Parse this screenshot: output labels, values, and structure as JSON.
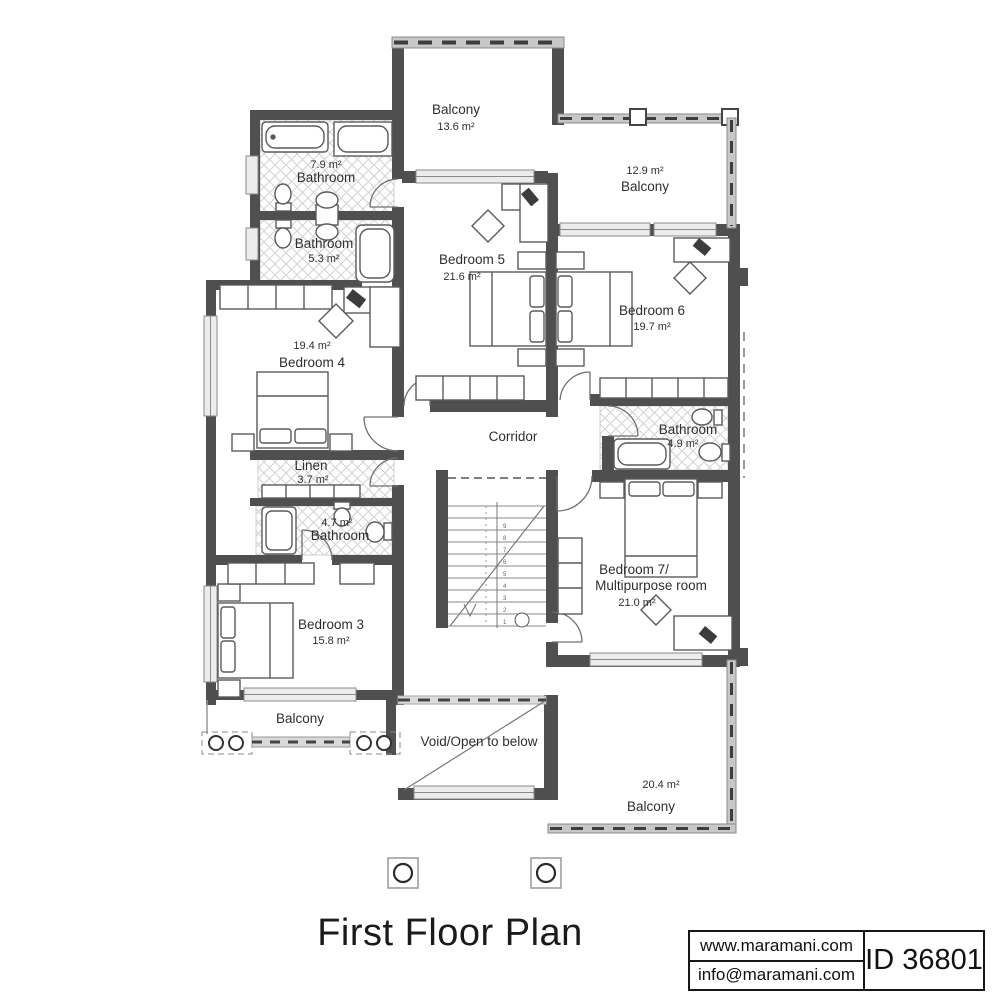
{
  "title": "First Floor Plan",
  "branding": {
    "website": "www.maramani.com",
    "email": "info@maramani.com",
    "plan_id": "ID 36801"
  },
  "rooms": {
    "balcony_top": {
      "name": "Balcony",
      "area": "13.6 m²"
    },
    "balcony_right": {
      "area": "12.9 m²",
      "name": "Balcony"
    },
    "bathroom_top": {
      "area": "7.9 m²",
      "name": "Bathroom"
    },
    "bathroom_mid": {
      "name": "Bathroom",
      "area": "5.3 m²"
    },
    "bedroom5": {
      "name": "Bedroom 5",
      "area": "21.6 m²"
    },
    "bedroom6": {
      "name": "Bedroom 6",
      "area": "19.7 m²"
    },
    "bedroom4": {
      "area": "19.4 m²",
      "name": "Bedroom 4"
    },
    "linen": {
      "name": "Linen",
      "area": "3.7 m²"
    },
    "corridor": {
      "name": "Corridor"
    },
    "bathroom_49": {
      "name": "Bathroom",
      "area": "4.9 m²"
    },
    "bathroom_47": {
      "area": "4.7 m²",
      "name": "Bathroom"
    },
    "bedroom3": {
      "name": "Bedroom 3",
      "area": "15.8 m²"
    },
    "bedroom7": {
      "name_line1": "Bedroom 7/",
      "name_line2": "Multipurpose room",
      "area": "21.0 m²"
    },
    "void": {
      "name": "Void/Open to below"
    },
    "balcony_bottom_left": {
      "name": "Balcony"
    },
    "balcony_bottom_right": {
      "area": "20.4 m²",
      "name": "Balcony"
    }
  },
  "stairs": {
    "numbers": [
      "1",
      "2",
      "3",
      "4",
      "5",
      "6",
      "7",
      "8",
      "9"
    ]
  }
}
